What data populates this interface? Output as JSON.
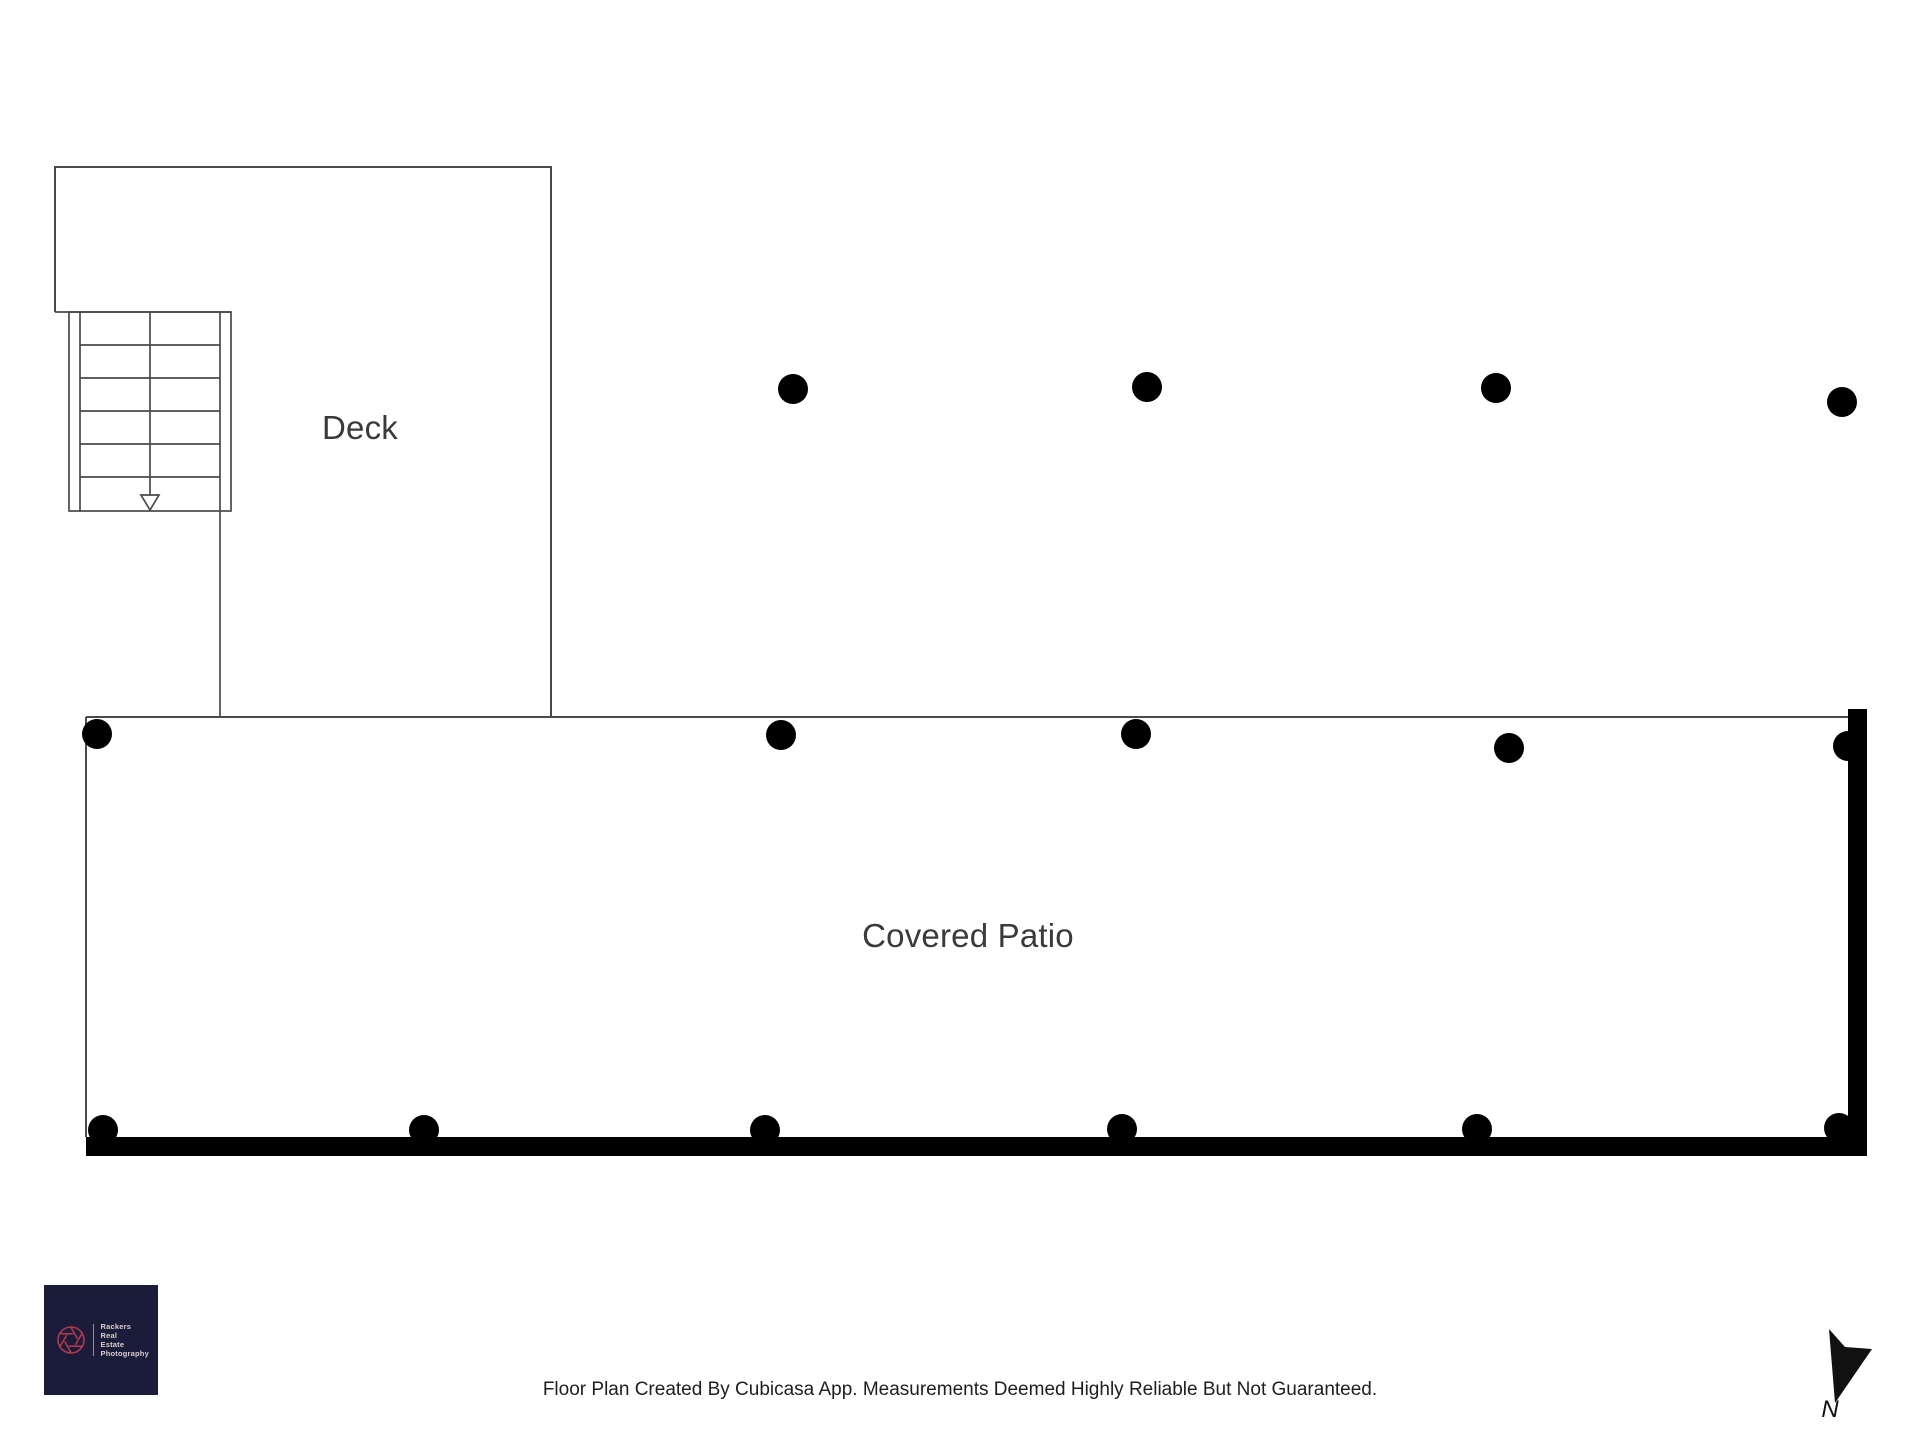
{
  "page": {
    "background": "#ffffff",
    "type": "floor-plan"
  },
  "floorplan": {
    "rooms": [
      {
        "label": "Deck"
      },
      {
        "label": "Covered Patio"
      }
    ],
    "stairs": {
      "steps": 6,
      "direction_arrow": "down"
    },
    "line_color": "#4a4a4a",
    "wall_color": "#000000",
    "posts": {
      "color": "#000000",
      "radius": 15,
      "positions": [
        [
          793,
          389
        ],
        [
          1147,
          387
        ],
        [
          1496,
          388
        ],
        [
          1842,
          402
        ],
        [
          97,
          734
        ],
        [
          781,
          735
        ],
        [
          1136,
          734
        ],
        [
          1509,
          748
        ],
        [
          1848,
          746
        ],
        [
          103,
          1130
        ],
        [
          424,
          1130
        ],
        [
          765,
          1130
        ],
        [
          1122,
          1129
        ],
        [
          1477,
          1129
        ],
        [
          1839,
          1128
        ]
      ]
    }
  },
  "footer": {
    "disclaimer": "Floor Plan Created By Cubicasa App. Measurements Deemed Highly Reliable But Not Guaranteed."
  },
  "logo": {
    "background": "#1b1c3a",
    "accent": "#b23a4e",
    "text_color": "#ddcdd2",
    "lines": [
      "Rackers",
      "Real",
      "Estate",
      "Photography"
    ]
  },
  "compass": {
    "label": "N",
    "color": "#111111"
  }
}
